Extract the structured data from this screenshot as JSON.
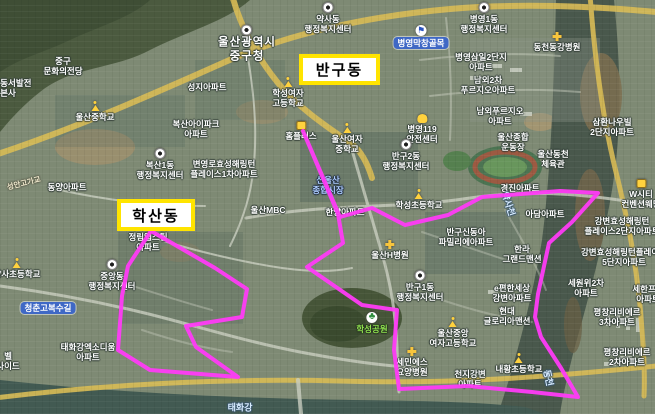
{
  "map": {
    "width": 655,
    "height": 414,
    "kind": "satellite"
  },
  "overlay": {
    "outline_color": "#ff3bf7",
    "box_border_color": "#ffe400",
    "dong_boxes": [
      {
        "id": "bangu-dong-label",
        "text": "반구동",
        "x": 299,
        "y": 54,
        "w": 81,
        "h": 31
      },
      {
        "id": "haksan-dong-label",
        "text": "학산동",
        "x": 117,
        "y": 199,
        "w": 78,
        "h": 32
      }
    ],
    "polygons": [
      {
        "id": "haksan-dong-outline",
        "points": "151,231 215,268 247,289 242,317 186,326 196,347 238,377 150,370 118,350 122,296 128,266"
      },
      {
        "id": "bangu-dong-outline",
        "points": "303,131 338,214 343,243 307,267 362,305 397,310 394,350 399,389 468,386 532,392 578,397 561,368 541,337 535,317 538,294 549,243 572,222 598,193 560,191 482,197 448,215 405,225 372,208 340,217"
      }
    ]
  },
  "labels": [
    {
      "id": "junggu-culture-hall",
      "lines": [
        "중구",
        "문화의전당"
      ],
      "x": 63,
      "y": 66,
      "type": "place"
    },
    {
      "id": "dongseo-power-hq",
      "lines": [
        "한국동서발전",
        "본사"
      ],
      "x": 8,
      "y": 88,
      "type": "place"
    },
    {
      "id": "ulsan-junggu-office",
      "lines": [
        "울산광역시",
        "중구청"
      ],
      "x": 247,
      "y": 44,
      "type": "city",
      "icon": "center"
    },
    {
      "id": "seongji-apt",
      "lines": [
        "성지아파트"
      ],
      "x": 207,
      "y": 87,
      "type": "apt"
    },
    {
      "id": "hakseong-girls-high-school",
      "lines": [
        "학성여자",
        "고등학교"
      ],
      "x": 288,
      "y": 93,
      "type": "place",
      "icon": "school"
    },
    {
      "id": "ulsan-middle-school",
      "lines": [
        "울산중학교"
      ],
      "x": 95,
      "y": 112,
      "type": "place",
      "icon": "school"
    },
    {
      "id": "boksan-ipark-apt",
      "lines": [
        "복산아이파크",
        "아파트"
      ],
      "x": 196,
      "y": 129,
      "type": "apt"
    },
    {
      "id": "boksan1-dong-center",
      "lines": [
        "복산1동",
        "행정복지센터"
      ],
      "x": 160,
      "y": 164,
      "type": "place",
      "icon": "center"
    },
    {
      "id": "byeonyeongno-hyosung-harrington-place1-apt",
      "lines": [
        "변영로효성해링턴",
        "플레이스1차아파트"
      ],
      "x": 224,
      "y": 169,
      "type": "apt"
    },
    {
      "id": "dongyang-apt",
      "lines": [
        "동양아파트"
      ],
      "x": 67,
      "y": 187,
      "type": "apt"
    },
    {
      "id": "seongan-overpass-road",
      "lines": [
        "성안고가교"
      ],
      "x": 24,
      "y": 184,
      "type": "road",
      "rotate": -14
    },
    {
      "id": "yaksa-dong-center",
      "lines": [
        "약사동",
        "행정복지센터"
      ],
      "x": 328,
      "y": 18,
      "type": "place",
      "icon": "center"
    },
    {
      "id": "byeongyeong1-dong-center",
      "lines": [
        "병영1동",
        "행정복지센터"
      ],
      "x": 484,
      "y": 18,
      "type": "place",
      "icon": "center"
    },
    {
      "id": "byeongyeong-makchang-alley",
      "lines": [
        "병영막창골목"
      ],
      "x": 421,
      "y": 37,
      "type": "street",
      "icon": "flag"
    },
    {
      "id": "dongcheon-donggang-hospital",
      "lines": [
        "동천동강병원"
      ],
      "x": 557,
      "y": 42,
      "type": "place",
      "icon": "cross"
    },
    {
      "id": "byeongyeong-samil-2danji-apt",
      "lines": [
        "병영삼일2단지",
        "아파트"
      ],
      "x": 481,
      "y": 62,
      "type": "apt"
    },
    {
      "id": "namoe-2cha-prugio-apt",
      "lines": [
        "남외2차",
        "푸르지오아파트"
      ],
      "x": 488,
      "y": 85,
      "type": "apt"
    },
    {
      "id": "namoe-prugio-apt",
      "lines": [
        "남외푸르지오",
        "아파트"
      ],
      "x": 500,
      "y": 116,
      "type": "apt"
    },
    {
      "id": "samhwan-nauvill-2danji-apt",
      "lines": [
        "삼환나우빌",
        "2단지아파트"
      ],
      "x": 612,
      "y": 127,
      "type": "apt"
    },
    {
      "id": "byeongyeong-119-safety-center",
      "lines": [
        "병영119",
        "안전센터"
      ],
      "x": 422,
      "y": 129,
      "type": "place",
      "icon": "fire"
    },
    {
      "id": "bangu2-dong-center",
      "lines": [
        "반구2동",
        "행정복지센터"
      ],
      "x": 406,
      "y": 155,
      "type": "place",
      "icon": "center"
    },
    {
      "id": "ulsan-sports-complex",
      "lines": [
        "울산종합",
        "운동장"
      ],
      "x": 513,
      "y": 142,
      "type": "place"
    },
    {
      "id": "ulsan-dongcheon-gym",
      "lines": [
        "울산동천",
        "체육관"
      ],
      "x": 553,
      "y": 159,
      "type": "place"
    },
    {
      "id": "gyeongjin-apt",
      "lines": [
        "경진아파트"
      ],
      "x": 520,
      "y": 188,
      "type": "apt"
    },
    {
      "id": "wcity-convention-wedding",
      "lines": [
        "W시티",
        "컨벤션웨딩"
      ],
      "x": 641,
      "y": 194,
      "type": "place",
      "icon": "market"
    },
    {
      "id": "hakseong-elementary-school",
      "lines": [
        "학성초등학교"
      ],
      "x": 419,
      "y": 200,
      "type": "place",
      "icon": "school"
    },
    {
      "id": "homeplus",
      "lines": [
        "홈플러스"
      ],
      "x": 301,
      "y": 131,
      "type": "place",
      "icon": "market"
    },
    {
      "id": "ulsan-girls-middle-school",
      "lines": [
        "울산여자",
        "중학교"
      ],
      "x": 347,
      "y": 139,
      "type": "place",
      "icon": "school"
    },
    {
      "id": "sinulsan-market",
      "lines": [
        "신울산",
        "종합시장"
      ],
      "x": 328,
      "y": 185,
      "type": "market"
    },
    {
      "id": "ulsan-mbc",
      "lines": [
        "울산MBC"
      ],
      "x": 268,
      "y": 210,
      "type": "place"
    },
    {
      "id": "hanyang-apt",
      "lines": [
        "한양아파트"
      ],
      "x": 345,
      "y": 212,
      "type": "apt"
    },
    {
      "id": "bangu-shindonga-famille-apt",
      "lines": [
        "반구신동아",
        "파밀리에아파트"
      ],
      "x": 466,
      "y": 237,
      "type": "apt"
    },
    {
      "id": "ulsan-h-hospital",
      "lines": [
        "울산H병원"
      ],
      "x": 390,
      "y": 250,
      "type": "place",
      "icon": "cross"
    },
    {
      "id": "bangu1-dong-center",
      "lines": [
        "반구1동",
        "행정복지센터"
      ],
      "x": 420,
      "y": 286,
      "type": "place",
      "icon": "center"
    },
    {
      "id": "adam-apt",
      "lines": [
        "아담아파트"
      ],
      "x": 545,
      "y": 214,
      "type": "apt"
    },
    {
      "id": "gangbyeon-hyosung-harrington-place2-apt",
      "lines": [
        "강변효성해링턴",
        "플레이스2단지아파트"
      ],
      "x": 622,
      "y": 226,
      "type": "apt"
    },
    {
      "id": "gangbyeon-hyosung-harrington-place5-apt",
      "lines": [
        "강변효성해링턴플레이스",
        "5단지아파트"
      ],
      "x": 624,
      "y": 257,
      "type": "apt"
    },
    {
      "id": "halla-grand-mansion",
      "lines": [
        "한라",
        "그랜드맨션"
      ],
      "x": 522,
      "y": 254,
      "type": "apt"
    },
    {
      "id": "epyeonhansesang-gangbyeon-apt",
      "lines": [
        "e편한세상",
        "강변아파트"
      ],
      "x": 512,
      "y": 293,
      "type": "apt"
    },
    {
      "id": "sewon-2cha-apt",
      "lines": [
        "세원위2차",
        "아파트"
      ],
      "x": 586,
      "y": 288,
      "type": "apt"
    },
    {
      "id": "sehan-apt",
      "lines": [
        "세한프라",
        "아파트"
      ],
      "x": 648,
      "y": 294,
      "type": "apt"
    },
    {
      "id": "hyundai-gloria-mansion",
      "lines": [
        "현대",
        "글로리아맨션"
      ],
      "x": 507,
      "y": 316,
      "type": "apt"
    },
    {
      "id": "ulsan-jungang-girls-high-school",
      "lines": [
        "울산중앙",
        "여자고등학교"
      ],
      "x": 453,
      "y": 333,
      "type": "place",
      "icon": "school"
    },
    {
      "id": "semin-s-nursing-hospital",
      "lines": [
        "세민에스",
        "요양병원"
      ],
      "x": 412,
      "y": 362,
      "type": "place",
      "icon": "cross"
    },
    {
      "id": "hakseong-park",
      "lines": [
        "학성공원"
      ],
      "x": 372,
      "y": 323,
      "type": "park",
      "icon": "tree"
    },
    {
      "id": "cheonji-gangbyeon-apt",
      "lines": [
        "천지강변",
        "아파트"
      ],
      "x": 470,
      "y": 379,
      "type": "apt"
    },
    {
      "id": "naehwang-elementary-school",
      "lines": [
        "내황초등학교"
      ],
      "x": 519,
      "y": 364,
      "type": "place",
      "icon": "school"
    },
    {
      "id": "pyeongchang-riviere-3cha-apt",
      "lines": [
        "평창리비에르",
        "3차아파트"
      ],
      "x": 617,
      "y": 317,
      "type": "apt"
    },
    {
      "id": "pyeongchang-riviere-2cha-apt",
      "lines": [
        "평창리비에르",
        "2차아파트"
      ],
      "x": 627,
      "y": 357,
      "type": "apt"
    },
    {
      "id": "yangsa-elementary-school",
      "lines": [
        "양사초등학교"
      ],
      "x": 17,
      "y": 269,
      "type": "place",
      "icon": "school"
    },
    {
      "id": "jungang-dong-center",
      "lines": [
        "중앙동",
        "행정복지센터"
      ],
      "x": 112,
      "y": 275,
      "type": "place",
      "icon": "center"
    },
    {
      "id": "jeongrim-epsteel-apt",
      "lines": [
        "정림엡스틸",
        "아파트"
      ],
      "x": 148,
      "y": 242,
      "type": "apt"
    },
    {
      "id": "cheongchun-gobeoksu-gil",
      "lines": [
        "청춘고복수길"
      ],
      "x": 48,
      "y": 308,
      "type": "street"
    },
    {
      "id": "taehwagang-exodium-apt",
      "lines": [
        "태화강엑소디움",
        "아파트"
      ],
      "x": 88,
      "y": 352,
      "type": "apt"
    },
    {
      "id": "riverside-apt",
      "lines": [
        "벨",
        "사이드"
      ],
      "x": 8,
      "y": 361,
      "type": "apt"
    },
    {
      "id": "taehwa-river",
      "lines": [
        "태화강"
      ],
      "x": 240,
      "y": 408,
      "type": "river"
    },
    {
      "id": "dongcheon-river",
      "lines": [
        "동천"
      ],
      "x": 548,
      "y": 378,
      "type": "river",
      "rotate": 78
    },
    {
      "id": "yaksa-stream",
      "lines": [
        "약사천"
      ],
      "x": 508,
      "y": 204,
      "type": "river",
      "rotate": 72
    }
  ]
}
